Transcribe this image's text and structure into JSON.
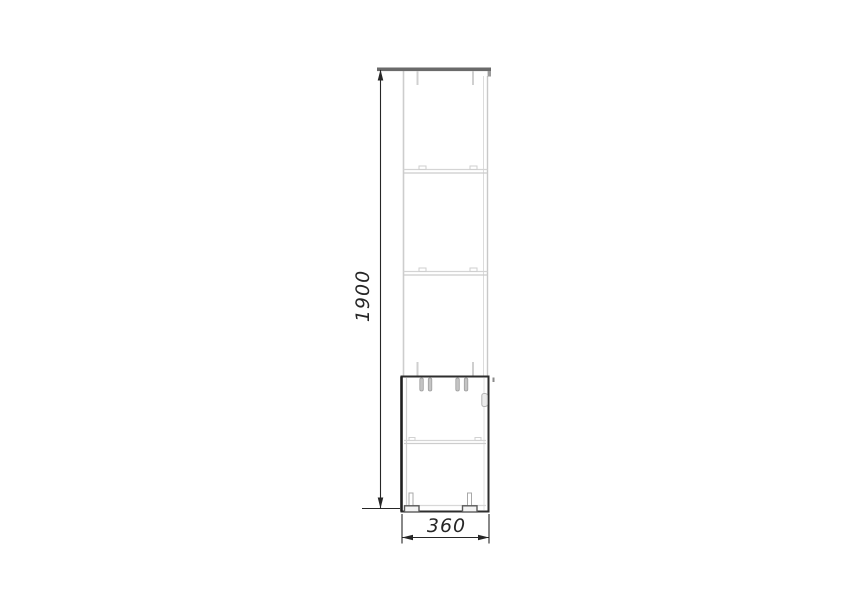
{
  "drawing": {
    "kind": "furniture-technical-drawing",
    "view": "side-elevation",
    "height_dimension": {
      "label": "1900"
    },
    "width_dimension": {
      "label": "360"
    },
    "colors": {
      "background": "#ffffff",
      "dimension": "#262626",
      "light_outline": "#d0d0d0",
      "dark_outline": "#2e2e2e",
      "top_panel": "#6a6a6a",
      "dowel_fill": "#c4c4c4"
    }
  }
}
